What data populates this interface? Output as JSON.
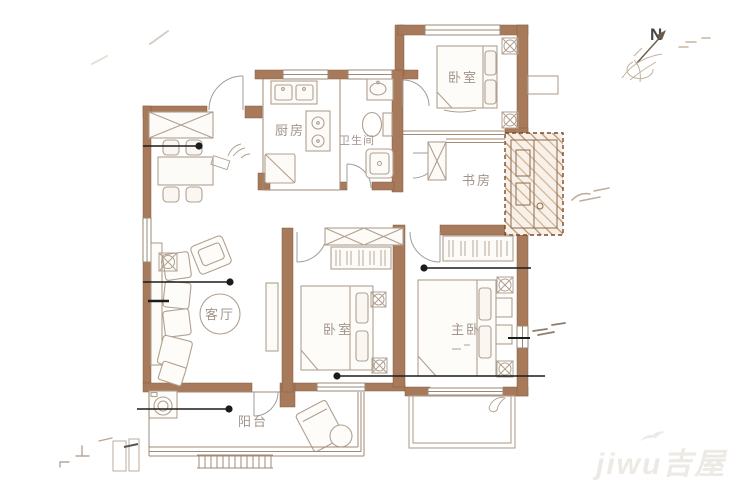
{
  "plan": {
    "rooms": [
      {
        "id": "kitchen",
        "label": "厨房"
      },
      {
        "id": "bathroom",
        "label": "卫生间"
      },
      {
        "id": "bedroom-north",
        "label": "卧室"
      },
      {
        "id": "study",
        "label": "书房"
      },
      {
        "id": "living-room",
        "label": "客厅"
      },
      {
        "id": "bedroom-middle",
        "label": "卧室"
      },
      {
        "id": "master-bedroom",
        "label": "主卧"
      },
      {
        "id": "balcony",
        "label": "阳台"
      }
    ],
    "compass": {
      "label": "N"
    },
    "watermark": {
      "text": "jiwu吉屋"
    },
    "colors": {
      "wall": "#a87a5c",
      "furniture_line": "#b0a090",
      "label_text": "#a3938a",
      "leader_line": "#1c1c1c",
      "hatch": "#c08e5f",
      "watermark": "#edeae6"
    }
  }
}
